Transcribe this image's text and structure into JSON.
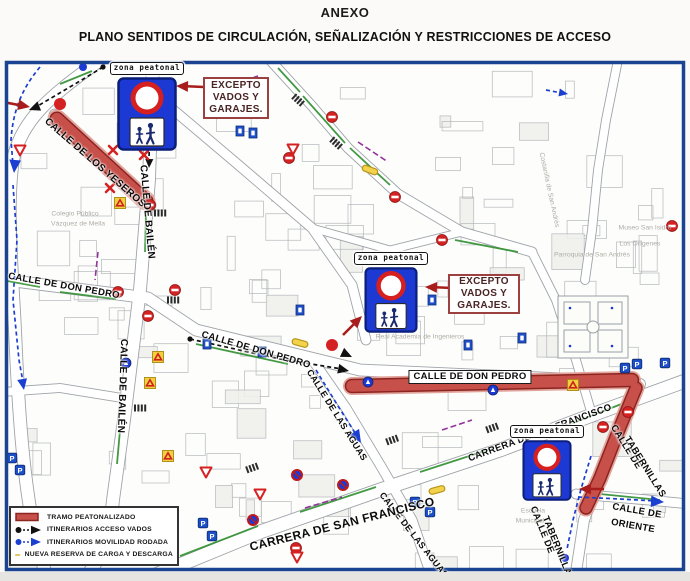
{
  "header": {
    "title": "ANEXO",
    "subtitle": "PLANO SENTIDOS DE CIRCULACIÓN, SEÑALIZACIÓN Y RESTRICCIONES DE ACCESO"
  },
  "colors": {
    "pedestrian_red": "#c7514a",
    "itinerary_black": "#111111",
    "itinerary_blue": "#1b3fd0",
    "reserve_yellow": "#f2d24b",
    "sign_blue": "#1d39d4",
    "no_entry_red": "#d42222",
    "annotation_red": "#a81c1c",
    "map_border_blue": "#1a4492"
  },
  "legend": {
    "items": [
      {
        "icon": "red-band-swatch",
        "label": "TRAMO PEATONALIZADO"
      },
      {
        "icon": "black-itinerary-swatch",
        "label": "ITINERARIOS ACCESO VADOS"
      },
      {
        "icon": "blue-itinerary-swatch",
        "label": "ITINERARIOS MOVILIDAD RODADA"
      },
      {
        "icon": "yellow-reserve-swatch",
        "label": "NUEVA RESERVA DE CARGA Y DESCARGA"
      }
    ]
  },
  "map": {
    "zona_signs": [
      {
        "label": "zona peatonal",
        "x": 117,
        "y": 62,
        "w": 60,
        "h": 74
      },
      {
        "label": "zona peatonal",
        "x": 362,
        "y": 252,
        "w": 58,
        "h": 66
      },
      {
        "label": "zona peatonal",
        "x": 517,
        "y": 425,
        "w": 60,
        "h": 61
      }
    ],
    "excepto_boxes": [
      {
        "lines": [
          "EXCEPTO",
          "VADOS Y",
          "GARAJES."
        ],
        "x": 203,
        "y": 77,
        "w": 66,
        "h": 42
      },
      {
        "lines": [
          "EXCEPTO",
          "VADOS Y",
          "GARAJES."
        ],
        "x": 448,
        "y": 274,
        "w": 72,
        "h": 40
      }
    ],
    "street_labels": [
      {
        "text": "CALLE DE LOS YESEROS",
        "x": 95,
        "y": 163,
        "rot": 41,
        "size": 10
      },
      {
        "text": "CALLE DE BAILÉN",
        "x": 147,
        "y": 212,
        "rot": 85,
        "size": 10
      },
      {
        "text": "CALLE DE BAILÉN",
        "x": 122,
        "y": 386,
        "rot": 92,
        "size": 10
      },
      {
        "text": "CALLE DE DON PEDRO",
        "x": 64,
        "y": 286,
        "rot": 10,
        "size": 9.5
      },
      {
        "text": "CALLE DE DON PEDRO",
        "x": 256,
        "y": 350,
        "rot": 16,
        "size": 9.5
      },
      {
        "text": "CALLE DE DON PEDRO",
        "x": 470,
        "y": 377,
        "rot": 0,
        "size": 9.5,
        "boxed": true
      },
      {
        "text": "CALLE DE LAS AGUAS",
        "x": 337,
        "y": 415,
        "rot": 58,
        "size": 9
      },
      {
        "text": "CALLE DE LAS AGUAS",
        "x": 414,
        "y": 535,
        "rot": 52,
        "size": 9
      },
      {
        "text": "CARRERA DE SAN FRANCISCO",
        "x": 342,
        "y": 524,
        "rot": -14,
        "size": 12
      },
      {
        "text": "CARRERA DE SAN FRANCISCO",
        "x": 540,
        "y": 433,
        "rot": -20,
        "size": 9.5
      },
      {
        "text": "CALLE DE",
        "x": 626,
        "y": 447,
        "rot": 58,
        "size": 9.5
      },
      {
        "text": "TABERNILLAS",
        "x": 645,
        "y": 467,
        "rot": 58,
        "size": 9.5
      },
      {
        "text": "CALLE DE",
        "x": 542,
        "y": 530,
        "rot": 68,
        "size": 9.5
      },
      {
        "text": "TABERNILLAS",
        "x": 558,
        "y": 549,
        "rot": 68,
        "size": 9.5
      },
      {
        "text": "CALLE DE",
        "x": 637,
        "y": 511,
        "rot": 10,
        "size": 9.5
      },
      {
        "text": "ORIENTE",
        "x": 633,
        "y": 526,
        "rot": 10,
        "size": 9.5
      }
    ],
    "poi_labels": [
      {
        "text": "Colegio Público",
        "x": 75,
        "y": 214,
        "rot": 0
      },
      {
        "text": "Vázquez de Mella",
        "x": 78,
        "y": 224,
        "rot": 0
      },
      {
        "text": "Real Academia de Ingenieros",
        "x": 420,
        "y": 337,
        "rot": 0
      },
      {
        "text": "Museo San Isidro",
        "x": 645,
        "y": 228,
        "rot": 0
      },
      {
        "text": "Los Orígenes",
        "x": 640,
        "y": 244,
        "rot": 0
      },
      {
        "text": "Parroquia de San Andrés",
        "x": 592,
        "y": 255,
        "rot": 0
      },
      {
        "text": "Escuela",
        "x": 533,
        "y": 511,
        "rot": 0
      },
      {
        "text": "Municipal",
        "x": 530,
        "y": 521,
        "rot": 0
      },
      {
        "text": "Costanilla de San Andrés",
        "x": 549,
        "y": 190,
        "rot": 78
      }
    ],
    "icons": [
      {
        "type": "noentry",
        "x": 150,
        "y": 205
      },
      {
        "type": "noentry",
        "x": 332,
        "y": 117
      },
      {
        "type": "noentry",
        "x": 289,
        "y": 158
      },
      {
        "type": "noentry",
        "x": 175,
        "y": 290
      },
      {
        "type": "noentry",
        "x": 148,
        "y": 316
      },
      {
        "type": "noentry",
        "x": 118,
        "y": 292
      },
      {
        "type": "noentry",
        "x": 672,
        "y": 226
      },
      {
        "type": "noentry",
        "x": 628,
        "y": 412
      },
      {
        "type": "noentry",
        "x": 603,
        "y": 427
      },
      {
        "type": "noentry",
        "x": 395,
        "y": 197
      },
      {
        "type": "noentry",
        "x": 442,
        "y": 240
      },
      {
        "type": "noentry",
        "x": 296,
        "y": 548
      },
      {
        "type": "nostop",
        "x": 297,
        "y": 475
      },
      {
        "type": "nostop",
        "x": 343,
        "y": 485
      },
      {
        "type": "nostop",
        "x": 253,
        "y": 520
      },
      {
        "type": "park",
        "x": 203,
        "y": 523
      },
      {
        "type": "park",
        "x": 212,
        "y": 536
      },
      {
        "type": "park",
        "x": 625,
        "y": 368
      },
      {
        "type": "park",
        "x": 637,
        "y": 364
      },
      {
        "type": "park",
        "x": 665,
        "y": 363
      },
      {
        "type": "park",
        "x": 415,
        "y": 502
      },
      {
        "type": "park",
        "x": 430,
        "y": 512
      },
      {
        "type": "park",
        "x": 12,
        "y": 458
      },
      {
        "type": "park",
        "x": 20,
        "y": 470
      },
      {
        "type": "yield",
        "x": 293,
        "y": 149
      },
      {
        "type": "yield",
        "x": 20,
        "y": 150
      },
      {
        "type": "yield",
        "x": 260,
        "y": 494
      },
      {
        "type": "yield",
        "x": 297,
        "y": 557
      },
      {
        "type": "yield",
        "x": 206,
        "y": 472
      },
      {
        "type": "warn",
        "x": 158,
        "y": 357
      },
      {
        "type": "warn",
        "x": 150,
        "y": 383
      },
      {
        "type": "warn",
        "x": 168,
        "y": 456
      },
      {
        "type": "warn",
        "x": 573,
        "y": 385
      },
      {
        "type": "warn",
        "x": 120,
        "y": 203
      },
      {
        "type": "cross",
        "x": 113,
        "y": 150
      },
      {
        "type": "cross",
        "x": 144,
        "y": 155
      },
      {
        "type": "cross",
        "x": 110,
        "y": 188
      },
      {
        "type": "zebra",
        "x": 150,
        "y": 118,
        "rot": 0
      },
      {
        "type": "zebra",
        "x": 160,
        "y": 213,
        "rot": 0
      },
      {
        "type": "zebra",
        "x": 173,
        "y": 300,
        "rot": 0
      },
      {
        "type": "zebra",
        "x": 140,
        "y": 408,
        "rot": 0
      },
      {
        "type": "zebra",
        "x": 298,
        "y": 100,
        "rot": 42
      },
      {
        "type": "zebra",
        "x": 336,
        "y": 143,
        "rot": 42
      },
      {
        "type": "zebra",
        "x": 252,
        "y": 468,
        "rot": -20
      },
      {
        "type": "zebra",
        "x": 392,
        "y": 440,
        "rot": -20
      },
      {
        "type": "zebra",
        "x": 492,
        "y": 428,
        "rot": -20
      },
      {
        "type": "yellowpill",
        "x": 370,
        "y": 170,
        "rot": 20
      },
      {
        "type": "yellowpill",
        "x": 300,
        "y": 343,
        "rot": 15
      },
      {
        "type": "yellowpill",
        "x": 437,
        "y": 490,
        "rot": -15
      },
      {
        "type": "bluesign",
        "x": 262,
        "y": 352
      },
      {
        "type": "bluesign",
        "x": 300,
        "y": 310
      },
      {
        "type": "bluesign",
        "x": 432,
        "y": 300
      },
      {
        "type": "bluesign",
        "x": 468,
        "y": 345
      },
      {
        "type": "bluesign",
        "x": 522,
        "y": 338
      },
      {
        "type": "bluesign",
        "x": 207,
        "y": 344
      },
      {
        "type": "bluesign",
        "x": 240,
        "y": 131
      },
      {
        "type": "bluesign",
        "x": 253,
        "y": 133
      },
      {
        "type": "bluecircle",
        "x": 368,
        "y": 382
      },
      {
        "type": "bluecircle",
        "x": 493,
        "y": 390
      },
      {
        "type": "bluecircle",
        "x": 126,
        "y": 363
      },
      {
        "type": "dotred",
        "x": 60,
        "y": 104
      },
      {
        "type": "dotred",
        "x": 332,
        "y": 345
      },
      {
        "type": "dotblue",
        "x": 83,
        "y": 67
      },
      {
        "type": "dotblue",
        "x": 565,
        "y": 558
      }
    ]
  }
}
